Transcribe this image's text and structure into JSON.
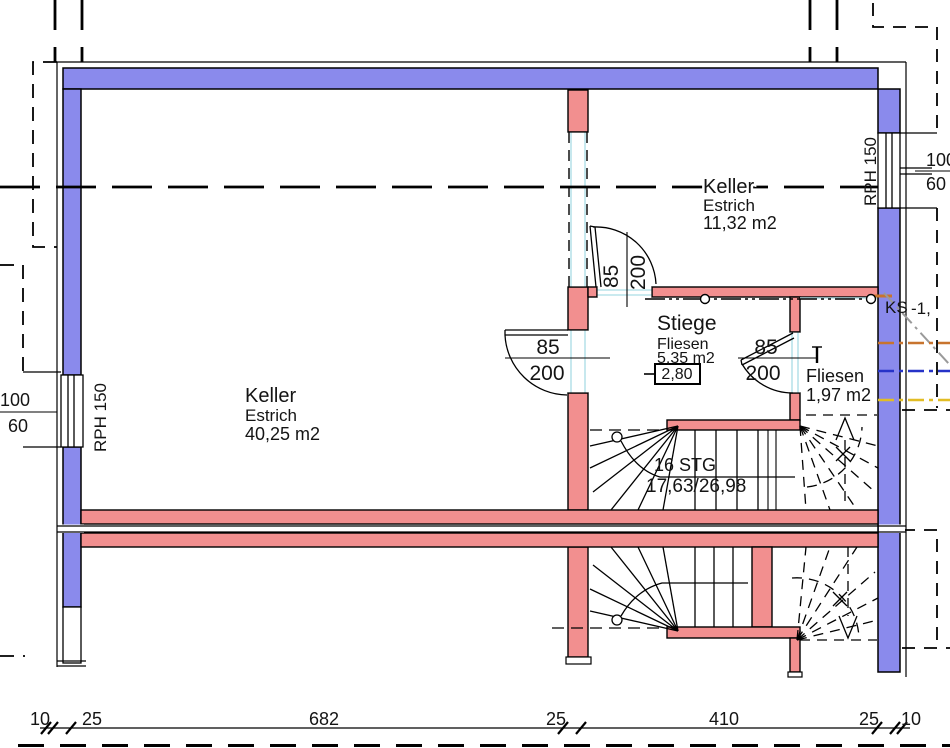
{
  "rooms": [
    {
      "name": "Keller",
      "finish": "Estrich",
      "area": "40,25 m2"
    },
    {
      "name": "Keller",
      "finish": "Estrich",
      "area": "11,32 m2"
    },
    {
      "name": "Stiege",
      "finish": "Fliesen",
      "area": "5,35 m2",
      "level": "2,80"
    },
    {
      "name": "Fliesen",
      "area": "1,97 m2"
    }
  ],
  "stair": {
    "count": "16 STG",
    "rise_run": "17,63/26,98"
  },
  "door": {
    "width": "85",
    "height": "200"
  },
  "window_left": {
    "label": "RPH 150",
    "width": "100",
    "height": "60"
  },
  "window_right": {
    "label": "RPH 150",
    "width": "100",
    "height": "60"
  },
  "utility": {
    "ks": "KS",
    "ks_value": "-1,"
  },
  "dims": [
    "10",
    "25",
    "682",
    "25",
    "410",
    "25",
    "10"
  ],
  "colors": {
    "wall_exterior": "#8a8aec",
    "wall_interior": "#f28f8f",
    "opening_cyan": "#b9e3ea",
    "ks_orange": "#c8742e",
    "pipe_blue": "#2633c8",
    "pipe_yellow": "#e2bd25",
    "pipe_gray": "#9a9a9a"
  }
}
